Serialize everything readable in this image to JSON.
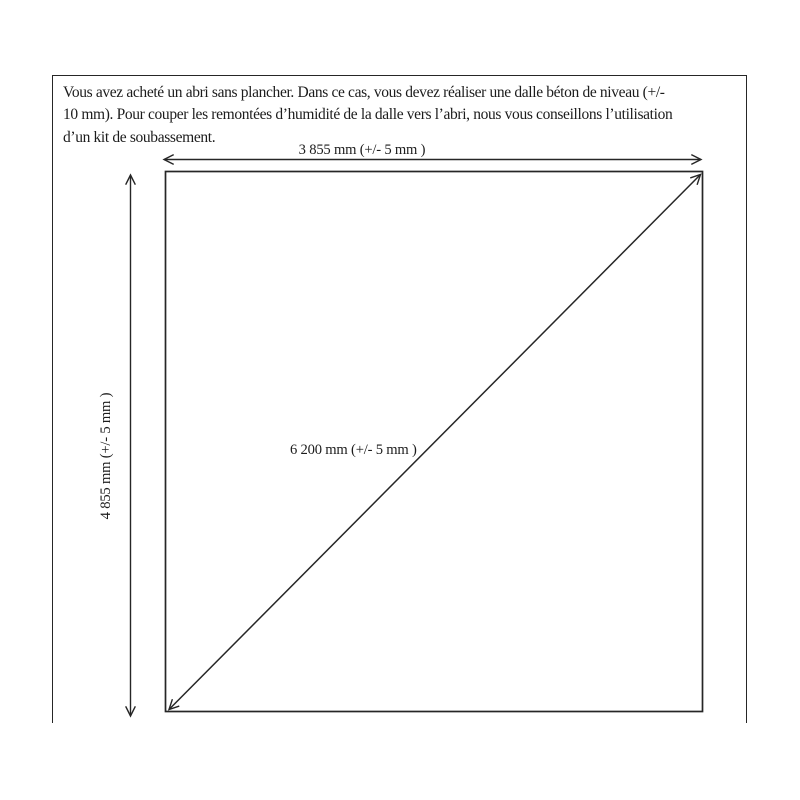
{
  "page": {
    "background": "#ffffff",
    "ink": "#262626"
  },
  "notice": {
    "lines": [
      "Vous avez acheté un abri sans plancher. Dans ce cas, vous devez réaliser une dalle béton de niveau (+/-",
      "10 mm). Pour couper les remontées d’humidité de la dalle vers l’abri, nous vous conseillons l’utilisation",
      "d’un kit de soubassement."
    ]
  },
  "diagram": {
    "description": "dimensioned concrete slab outline with diagonal check measurement",
    "dimensions": {
      "width_label": "3 855 mm (+/- 5 mm )",
      "height_label": "4 855 mm (+/- 5 mm )",
      "diagonal_label": "6 200 mm (+/- 5 mm )"
    }
  }
}
